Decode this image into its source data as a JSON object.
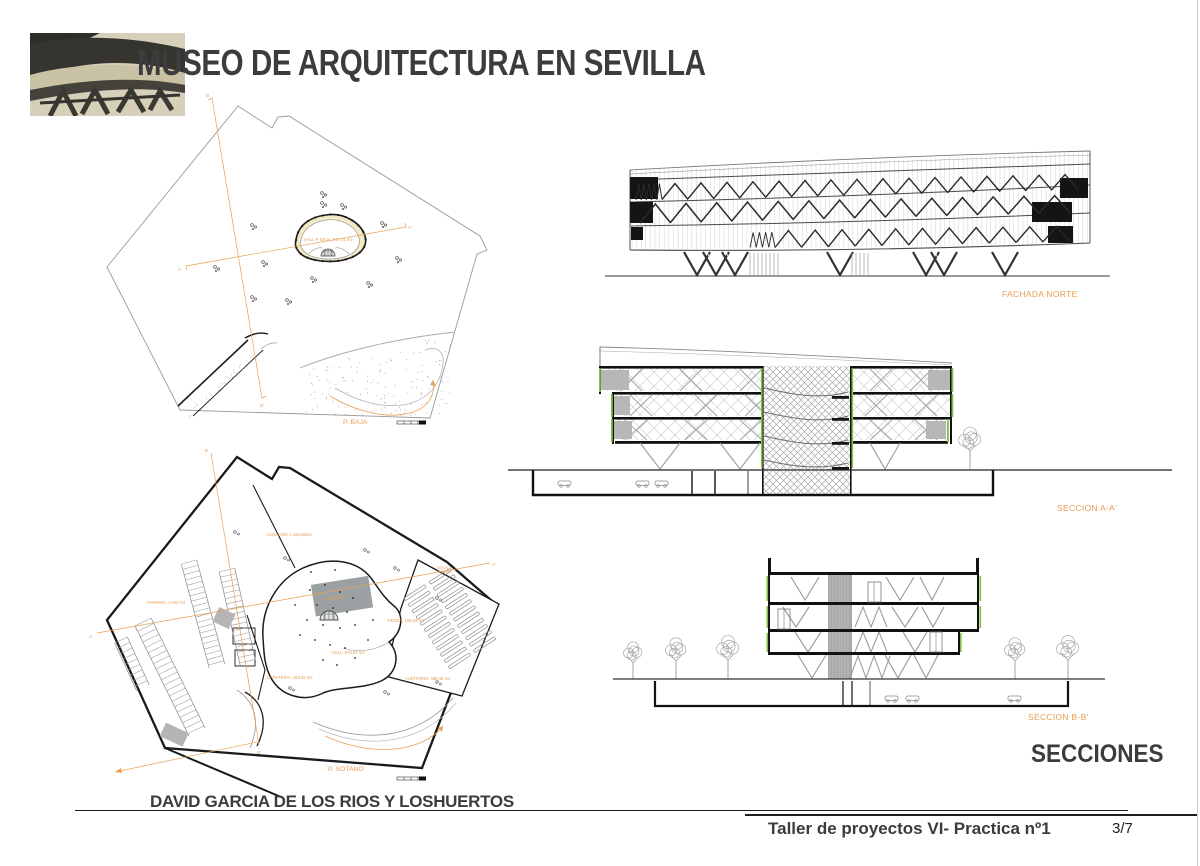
{
  "header": {
    "title": "MUSEO DE ARQUITECTURA EN SEVILLA"
  },
  "plan_baja": {
    "label": "P. BAJA",
    "hall_label": "HALL P. BAJA: 917,31 m2",
    "marker_a": "A",
    "marker_a_end": "A'",
    "marker_b": "B",
    "marker_b_end": "B'"
  },
  "plan_sotano": {
    "label": "P. SOTANO",
    "almacen_label": "ALMACEN: 1.344,86m2",
    "parking_label": "PARKING: 1.943 m2",
    "hall_label": "HALL: 876,51 m2",
    "tienda_label": "TIENDA: 195,03 m2",
    "cafeteria_label": "CAFETERIA: 163,82 m2",
    "auditorio_label": "AUDITORIO: 388,46 m2",
    "aseos_label_1": "ASEOS 2:",
    "aseos_label_2": "45,06 m2",
    "core_label": "ASCENSOR",
    "marker_a": "A",
    "marker_a_end": "A'",
    "marker_b": "B",
    "marker_b_end": "B'"
  },
  "elevations": {
    "fachada_norte_label": "FACHADA NORTE",
    "seccion_a_label": "SECCION A-A'",
    "seccion_b_label": "SECCION B-B'",
    "heading": "SECCIONES"
  },
  "footer": {
    "author": "DAVID GARCIA DE LOS RIOS Y LOSHUERTOS",
    "course": "Taller de proyectos VI- Practica nº1",
    "page": "3/7"
  },
  "colors": {
    "accent_orange": "#e89c54",
    "accent_green": "#7fc241",
    "ink": "#3c3c3e"
  }
}
